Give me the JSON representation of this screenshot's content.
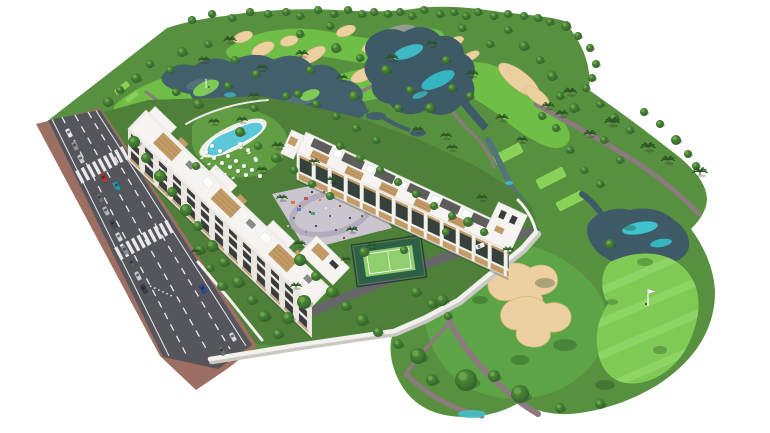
{
  "scene": {
    "description": "Aerial 3D architectural rendering of a white apartment complex (two residential blocks with wood-accent balconies and rooftop terraces, lagoon swimming pool with sun umbrellas, paddle tennis court, playground plaza, white boundary wall) beside a golf course with fairways, sand bunkers, lakes with turquoise shallows, palm trees, tee boxes and a putting green with flag pin; a diagonal avenue with parked and moving cars, crosswalks and brick sidewalks borders the complex on the left; background fades to white.",
    "inventory": {
      "residential_blocks": 2,
      "swimming_pools": 1,
      "paddle_tennis_courts": 1,
      "playground_plazas": 1,
      "boundary_walls": 1,
      "golf_bunkers": 19,
      "golf_lakes": 4,
      "tee_boxes": 5,
      "putting_greens": 3,
      "flag_pins": 2,
      "crosswalks": 2,
      "parked_cars": 11,
      "moving_cars": 5,
      "maintenance_carts": 1
    }
  },
  "colors": {
    "background": "#ffffff",
    "roughGreen": "#57913f",
    "fairwayGreen": "#6fbe46",
    "fairwayBright": "#5da447",
    "teeGreen": "#8ad159",
    "puttingGreen": "#7fca55",
    "puttingStripe": "#90d768",
    "gardenGreen": "#4e8039",
    "lawnGreen": "#619e43",
    "sand": "#ecd0a0",
    "sandEdge": "#d9b87f",
    "wasteGray": "#94a08f",
    "lakeDark": "#42606b",
    "lakeMid": "#54727c",
    "lakeSlate": "#3d5a66",
    "lakeTeal": "#3fc3cd",
    "roadAsphalt": "#54565c",
    "sidewalkBrick": "#9d6e62",
    "roadMarking": "#e9e9eb",
    "plazaPaving": "#cbc5d0",
    "plazaRing": "#b3acbc",
    "buildingWhite": "#f5f4f0",
    "facadeShade": "#e9e6df",
    "windowDark": "#3a3b3d",
    "glassDark": "#36413b",
    "woodAccent": "#c29b67",
    "woodSlat": "#a87f52",
    "wallWhite": "#f2f1ed",
    "wallShadow": "#cac8c2",
    "tennisOuter": "#2c6148",
    "tennisInner": "#8fcf6d",
    "fenceDark": "#2a363f",
    "cartPath": "#8b7a7e",
    "innerRoad": "#66666a",
    "treeDark": "#2d5a28",
    "treeMid": "#3f7431",
    "treeLight": "#5f9b3f",
    "palmGreen": "#2a5524",
    "poolWater": "#5ac8d8",
    "poolDeck": "#f0efe9",
    "carRed": "#b2372f",
    "carTeal": "#1e9aa8",
    "carBlue": "#2b4a9e",
    "flagWhite": "#f8f8f8"
  },
  "road": {
    "angle_deg": 62,
    "parked_cars": [
      [
        69,
        133,
        "#e9e9ea"
      ],
      [
        75,
        146,
        "#90929a"
      ],
      [
        81,
        159,
        "#c8c9cd"
      ],
      [
        100,
        198,
        "#6e7076"
      ],
      [
        106,
        211,
        "#b0b2b6"
      ],
      [
        113,
        224,
        "#484a50"
      ],
      [
        119,
        237,
        "#d9dadc"
      ],
      [
        125,
        250,
        "#8b8d93"
      ],
      [
        132,
        263,
        "#5a5c62"
      ],
      [
        138,
        276,
        "#caccce"
      ],
      [
        144,
        289,
        "#3c3e44"
      ]
    ],
    "moving_cars": [
      [
        104,
        178,
        "#b2372f"
      ],
      [
        117,
        186,
        "#1e9aa8"
      ],
      [
        203,
        289,
        "#2b4a9e"
      ],
      [
        233,
        337,
        "#d8d8da"
      ],
      [
        222,
        351,
        "#6a6c72"
      ]
    ],
    "maintenance_cart": [
      480,
      246,
      -22,
      "#fafafa"
    ]
  },
  "scatter": {
    "trees_round": [
      [
        192,
        20,
        4
      ],
      [
        212,
        14,
        4
      ],
      [
        232,
        18,
        4
      ],
      [
        250,
        12,
        4
      ],
      [
        268,
        14,
        4
      ],
      [
        286,
        12,
        4
      ],
      [
        300,
        16,
        4
      ],
      [
        318,
        10,
        4
      ],
      [
        334,
        14,
        4
      ],
      [
        348,
        10,
        4
      ],
      [
        362,
        14,
        4
      ],
      [
        374,
        12,
        4
      ],
      [
        388,
        14,
        4
      ],
      [
        400,
        12,
        4
      ],
      [
        412,
        16,
        4
      ],
      [
        424,
        10,
        4
      ],
      [
        440,
        14,
        4
      ],
      [
        454,
        12,
        4
      ],
      [
        466,
        16,
        4
      ],
      [
        478,
        12,
        4
      ],
      [
        494,
        16,
        4
      ],
      [
        508,
        14,
        4
      ],
      [
        524,
        16,
        4
      ],
      [
        538,
        18,
        4
      ],
      [
        550,
        22,
        4
      ],
      [
        108,
        102,
        5
      ],
      [
        120,
        90,
        4
      ],
      [
        136,
        78,
        5
      ],
      [
        150,
        64,
        4
      ],
      [
        176,
        92,
        4
      ],
      [
        182,
        52,
        5
      ],
      [
        170,
        70,
        4
      ],
      [
        208,
        44,
        4
      ],
      [
        235,
        60,
        4
      ],
      [
        198,
        104,
        5
      ],
      [
        256,
        74,
        4
      ],
      [
        286,
        96,
        4
      ],
      [
        310,
        70,
        4
      ],
      [
        336,
        48,
        5
      ],
      [
        360,
        58,
        4
      ],
      [
        386,
        70,
        5
      ],
      [
        410,
        90,
        4
      ],
      [
        300,
        34,
        4
      ],
      [
        330,
        26,
        4
      ],
      [
        354,
        96,
        5
      ],
      [
        254,
        108,
        4
      ],
      [
        228,
        86,
        4
      ],
      [
        398,
        108,
        4
      ],
      [
        430,
        108,
        5
      ],
      [
        452,
        88,
        4
      ],
      [
        470,
        96,
        4
      ],
      [
        446,
        60,
        4
      ],
      [
        462,
        28,
        4
      ],
      [
        490,
        44,
        4
      ],
      [
        508,
        30,
        4
      ],
      [
        524,
        46,
        5
      ],
      [
        540,
        60,
        4
      ],
      [
        552,
        76,
        5
      ],
      [
        560,
        96,
        4
      ],
      [
        574,
        108,
        5
      ],
      [
        586,
        88,
        4
      ],
      [
        600,
        104,
        4
      ],
      [
        566,
        26,
        5
      ],
      [
        578,
        36,
        4
      ],
      [
        590,
        48,
        4
      ],
      [
        596,
        64,
        4
      ],
      [
        592,
        78,
        4
      ],
      [
        614,
        118,
        5
      ],
      [
        630,
        130,
        4
      ],
      [
        644,
        112,
        4
      ],
      [
        660,
        124,
        4
      ],
      [
        676,
        140,
        5
      ],
      [
        688,
        154,
        4
      ],
      [
        696,
        166,
        4
      ],
      [
        604,
        140,
        4
      ],
      [
        620,
        160,
        4
      ],
      [
        584,
        170,
        4
      ],
      [
        600,
        184,
        4
      ],
      [
        570,
        150,
        4
      ],
      [
        556,
        128,
        4
      ],
      [
        542,
        116,
        4
      ],
      [
        610,
        244,
        5
      ],
      [
        418,
        356,
        8
      ],
      [
        442,
        300,
        6
      ],
      [
        466,
        380,
        11
      ],
      [
        520,
        394,
        9
      ],
      [
        494,
        376,
        6
      ],
      [
        398,
        344,
        5
      ],
      [
        432,
        380,
        6
      ],
      [
        560,
        408,
        5
      ],
      [
        600,
        404,
        5
      ],
      [
        134,
        142,
        6
      ],
      [
        146,
        158,
        5
      ],
      [
        160,
        176,
        6
      ],
      [
        172,
        192,
        5
      ],
      [
        186,
        210,
        6
      ],
      [
        198,
        226,
        5
      ],
      [
        212,
        246,
        6
      ],
      [
        224,
        262,
        5
      ],
      [
        238,
        282,
        6
      ],
      [
        252,
        300,
        5
      ],
      [
        264,
        316,
        6
      ],
      [
        278,
        334,
        5
      ],
      [
        240,
        132,
        5
      ],
      [
        258,
        146,
        4
      ],
      [
        276,
        158,
        5
      ],
      [
        294,
        170,
        4
      ],
      [
        312,
        184,
        4
      ],
      [
        330,
        196,
        4
      ],
      [
        300,
        260,
        6
      ],
      [
        316,
        276,
        5
      ],
      [
        332,
        292,
        6
      ],
      [
        346,
        306,
        5
      ],
      [
        362,
        320,
        6
      ],
      [
        378,
        332,
        5
      ],
      [
        304,
        302,
        7
      ],
      [
        288,
        318,
        6
      ],
      [
        416,
        292,
        5
      ],
      [
        432,
        304,
        5
      ],
      [
        448,
        316,
        4
      ],
      [
        364,
        252,
        5
      ],
      [
        404,
        250,
        4
      ],
      [
        446,
        232,
        4
      ],
      [
        468,
        222,
        5
      ],
      [
        484,
        232,
        4
      ],
      [
        340,
        146,
        4
      ],
      [
        360,
        158,
        4
      ],
      [
        380,
        170,
        4
      ],
      [
        398,
        182,
        4
      ],
      [
        416,
        194,
        4
      ],
      [
        434,
        206,
        4
      ],
      [
        452,
        216,
        4
      ],
      [
        356,
        128,
        4
      ],
      [
        376,
        140,
        4
      ],
      [
        336,
        116,
        4
      ],
      [
        316,
        104,
        4
      ],
      [
        298,
        94,
        4
      ],
      [
        200,
        250,
        5
      ],
      [
        210,
        268,
        4
      ],
      [
        222,
        286,
        5
      ],
      [
        196,
        166,
        4
      ]
    ],
    "palms": [
      [
        548,
        106,
        1
      ],
      [
        562,
        114,
        1
      ],
      [
        570,
        92,
        1.1
      ],
      [
        612,
        122,
        1.2
      ],
      [
        648,
        147,
        1.2
      ],
      [
        668,
        160,
        1.1
      ],
      [
        700,
        172,
        1.2
      ],
      [
        590,
        134,
        1
      ],
      [
        282,
        198,
        0.9
      ],
      [
        300,
        244,
        0.9
      ],
      [
        352,
        230,
        0.9
      ],
      [
        332,
        180,
        0.9
      ],
      [
        278,
        146,
        1
      ],
      [
        262,
        170,
        0.9
      ],
      [
        242,
        120,
        0.9
      ],
      [
        230,
        40,
        1
      ],
      [
        262,
        68,
        0.9
      ],
      [
        302,
        54,
        1
      ],
      [
        342,
        78,
        0.9
      ],
      [
        392,
        58,
        1
      ],
      [
        432,
        44,
        0.9
      ],
      [
        472,
        74,
        1
      ],
      [
        502,
        118,
        1
      ],
      [
        522,
        140,
        0.9
      ],
      [
        452,
        148,
        0.9
      ],
      [
        482,
        198,
        0.9
      ],
      [
        254,
        96,
        0.9
      ],
      [
        204,
        60,
        0.9
      ],
      [
        214,
        122,
        0.9
      ],
      [
        314,
        162,
        0.9
      ],
      [
        418,
        130,
        0.9
      ],
      [
        446,
        136,
        0.9
      ],
      [
        508,
        250,
        0.9
      ],
      [
        196,
        252,
        0.8
      ],
      [
        296,
        286,
        0.9
      ],
      [
        346,
        260,
        0.8
      ],
      [
        372,
        246,
        0.8
      ]
    ],
    "umbrellas": [
      [
        206,
        152
      ],
      [
        214,
        158
      ],
      [
        222,
        163
      ],
      [
        230,
        167
      ],
      [
        238,
        171
      ],
      [
        246,
        175
      ],
      [
        212,
        146
      ],
      [
        220,
        151
      ],
      [
        228,
        156
      ],
      [
        236,
        161
      ],
      [
        244,
        166
      ],
      [
        252,
        170
      ],
      [
        256,
        160
      ],
      [
        248,
        150
      ],
      [
        240,
        144
      ],
      [
        260,
        176
      ]
    ],
    "loungers": [
      [
        209,
        164
      ],
      [
        217,
        169
      ],
      [
        225,
        174
      ],
      [
        233,
        178
      ],
      [
        249,
        153
      ],
      [
        255,
        158
      ],
      [
        241,
        148
      ],
      [
        202,
        158
      ]
    ],
    "plaza_people": [
      [
        300,
        206,
        "#a33b34"
      ],
      [
        310,
        212,
        "#35404a"
      ],
      [
        320,
        200,
        "#d2803a"
      ],
      [
        330,
        216,
        "#4a5a8c"
      ],
      [
        340,
        206,
        "#a33b34"
      ],
      [
        316,
        226,
        "#35404a"
      ],
      [
        306,
        232,
        "#8a8a8a"
      ],
      [
        336,
        230,
        "#7a4a32"
      ],
      [
        350,
        218,
        "#35404a"
      ],
      [
        326,
        208,
        "#e8e8e8"
      ],
      [
        294,
        218,
        "#5a5a5a"
      ],
      [
        344,
        238,
        "#a33b34"
      ],
      [
        356,
        228,
        "#2c4a66"
      ],
      [
        312,
        192,
        "#35404a"
      ],
      [
        324,
        192,
        "#7a6248"
      ],
      [
        362,
        216,
        "#4a6a4a"
      ],
      [
        288,
        226,
        "#c0c0c0"
      ]
    ],
    "mow_shadows": [
      [
        545,
        283,
        10,
        5
      ],
      [
        565,
        345,
        12,
        6
      ],
      [
        605,
        385,
        10,
        5
      ],
      [
        645,
        262,
        8,
        4
      ],
      [
        520,
        360,
        9,
        5
      ],
      [
        480,
        300,
        8,
        4
      ],
      [
        612,
        302,
        6,
        3
      ],
      [
        660,
        350,
        7,
        4
      ],
      [
        630,
        228,
        6,
        3
      ]
    ]
  }
}
